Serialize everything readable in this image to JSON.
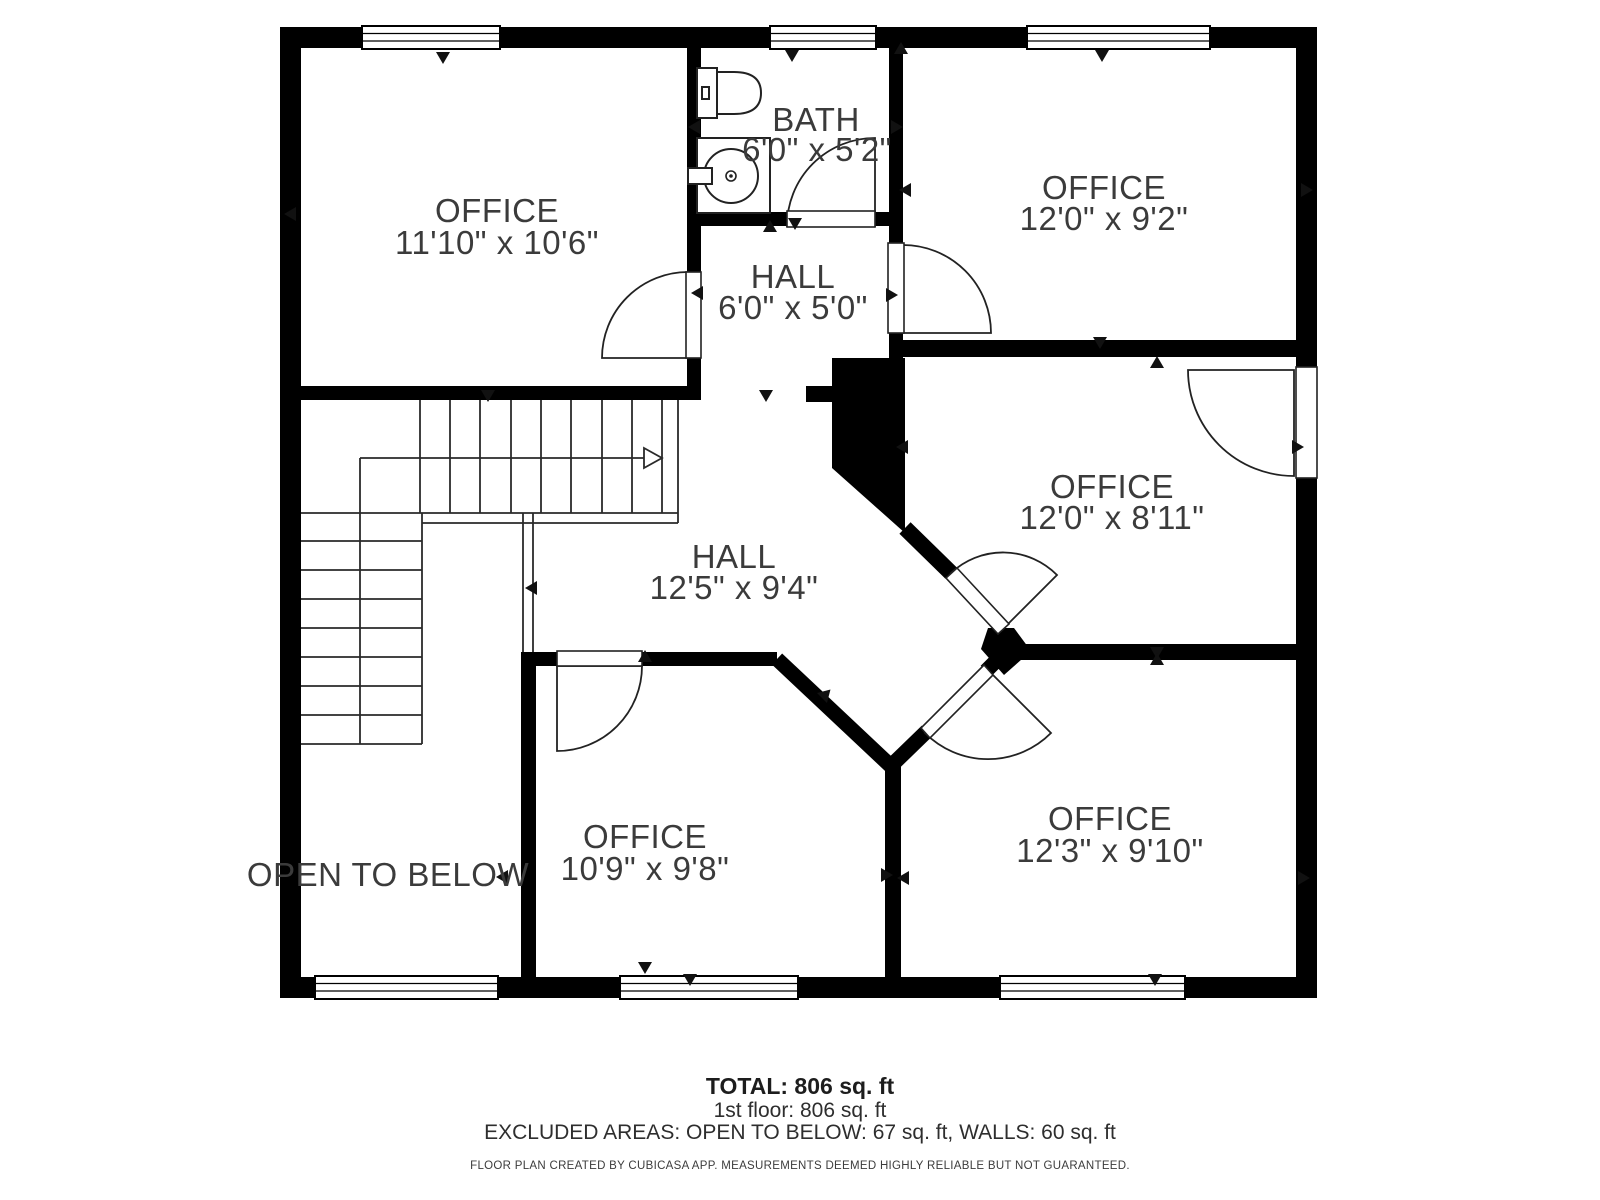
{
  "plan_type": "floor-plan",
  "rooms": [
    {
      "name": "OFFICE",
      "dims": "11'10\" x 10'6\""
    },
    {
      "name": "BATH",
      "dims": "6'0\" x 5'2\""
    },
    {
      "name": "HALL",
      "dims": "6'0\" x 5'0\""
    },
    {
      "name": "OFFICE",
      "dims": "12'0\" x 9'2\""
    },
    {
      "name": "OFFICE",
      "dims": "12'0\" x 8'11\""
    },
    {
      "name": "HALL",
      "dims": "12'5\" x 9'4\""
    },
    {
      "name": "OFFICE",
      "dims": "12'3\" x 9'10\""
    },
    {
      "name": "OFFICE",
      "dims": "10'9\" x 9'8\""
    },
    {
      "name": "OPEN TO BELOW",
      "dims": ""
    }
  ],
  "footer": {
    "total": "TOTAL: 806 sq. ft",
    "floor": "1st floor: 806 sq. ft",
    "excluded": "EXCLUDED AREAS: OPEN TO BELOW: 67 sq. ft, WALLS: 60 sq. ft",
    "disclaimer": "FLOOR PLAN CREATED BY CUBICASA APP. MEASUREMENTS DEEMED HIGHLY RELIABLE BUT NOT GUARANTEED."
  },
  "colors": {
    "wall": "#000000",
    "line": "#2a2a2a",
    "label": "#3b3b3b",
    "background": "#ffffff"
  }
}
